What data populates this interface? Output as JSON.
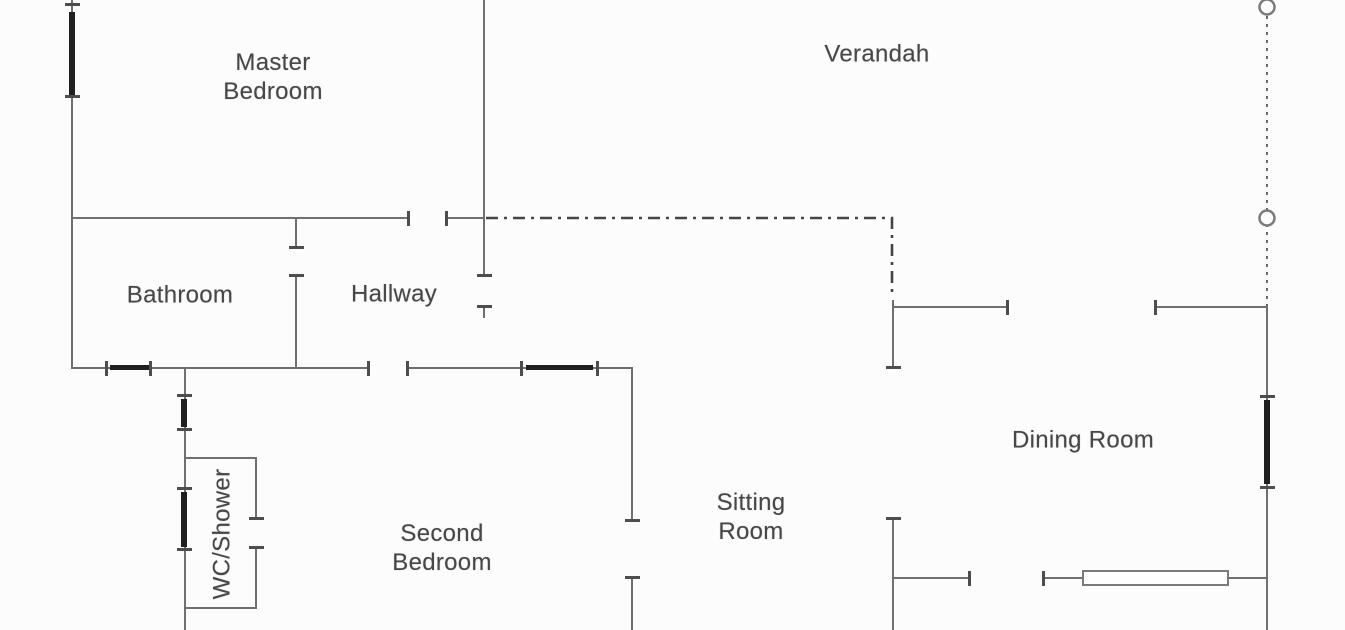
{
  "plan": {
    "rooms": {
      "master_bedroom": {
        "line1": "Master",
        "line2": "Bedroom"
      },
      "verandah": {
        "line1": "Verandah"
      },
      "bathroom": {
        "line1": "Bathroom"
      },
      "hallway": {
        "line1": "Hallway"
      },
      "wc_shower": {
        "line1": "WC/Shower"
      },
      "second_bedroom": {
        "line1": "Second",
        "line2": "Bedroom"
      },
      "sitting_room": {
        "line1": "Sitting",
        "line2": "Room"
      },
      "dining_room": {
        "line1": "Dining Room"
      }
    },
    "symbols": {
      "verandah_posts": 2,
      "window_markers": 6,
      "sliding_door_markers": 1
    },
    "colors": {
      "wall": "#6f6f6f",
      "window_marker": "#1f1f1f",
      "door_jamb": "#4d4d4d",
      "boundary_dashline": "#454545",
      "post_outline": "#7a7a7a",
      "text": "#474747",
      "background": "#fcfcfc"
    }
  }
}
